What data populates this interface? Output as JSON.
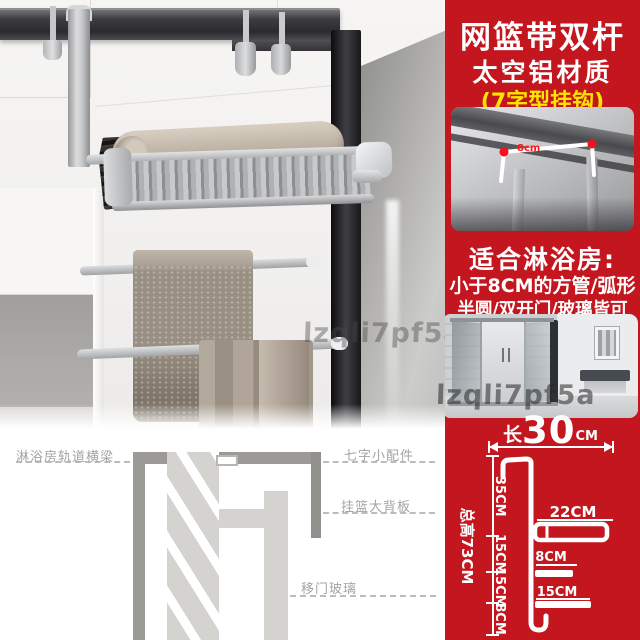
{
  "watermark": "lzqli7pf5a",
  "panel": {
    "title": "网篮带双杆",
    "material": "太空铝材质",
    "hook_type": "(7字型挂钩)",
    "hook_dim": "8cm",
    "fit": {
      "heading": "适合淋浴房:",
      "line1": "小于8CM的方管/弧形",
      "line2": "半圆/双开门/玻璃皆可"
    },
    "colors": {
      "background": "#c4161f",
      "highlight": "#ffe400"
    }
  },
  "install_diagram": {
    "labels": {
      "beam": "淋浴房轨道横梁",
      "hook_part": "七字小配件",
      "back_panel": "挂篮大背板",
      "door_glass": "移门玻璃"
    }
  },
  "dimensions": {
    "length": {
      "prefix": "长",
      "value": "30",
      "unit": "CM"
    },
    "total_height": "总高73CM",
    "segments": [
      "35CM",
      "15CM",
      "15CM",
      "8CM"
    ],
    "shelf_depth": "22CM",
    "bar_small": "8CM",
    "bar_large": "15CM"
  }
}
